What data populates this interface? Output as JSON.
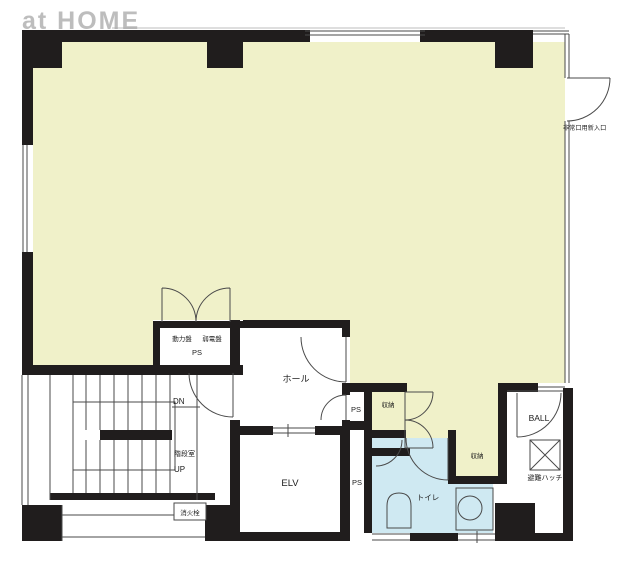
{
  "watermark": "at HOME",
  "colors": {
    "room": "#f0f1c9",
    "wet": "#cfe9f2",
    "wall": "#201d1d",
    "line": "#4a4a4a",
    "faint": "#bcbcbc",
    "text": "#1c1c1c",
    "watermark": "#a8a8a8"
  },
  "labels": {
    "panel_power": "動力盤",
    "panel_lowvolt": "弱電盤",
    "panel_ps": "PS",
    "hall": "ホール",
    "stair_dn": "DN",
    "stair_room": "階段室",
    "stair_up": "UP",
    "hydrant": "消火栓",
    "elevator": "ELV",
    "shaft_ps": "PS",
    "hall_ps": "PS",
    "storage_left": "収納",
    "storage_right": "収納",
    "toilet": "トイレ",
    "balcony": "BALL",
    "hatch": "避難ハッチ",
    "emergency_entrance": "非常口用新入口"
  }
}
